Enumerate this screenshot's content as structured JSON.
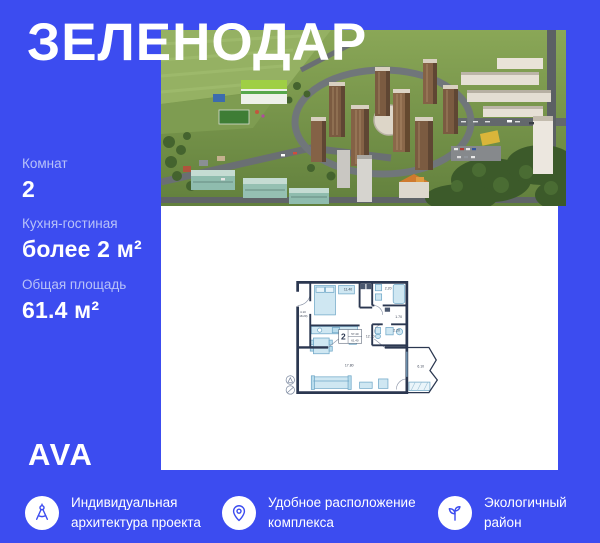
{
  "colors": {
    "background": "#3c4cf0",
    "muted_label_text": "#b8c2f8",
    "panel": "#ffffff",
    "plan_walls": "#2b3750",
    "plan_furniture_fill": "#cfe7f2",
    "icon_accent": "#3c4cf0"
  },
  "header": {
    "title": "ЗЕЛЕНОДАР"
  },
  "specs": [
    {
      "label": "Комнат",
      "value": "2"
    },
    {
      "label": "Кухня-гостиная",
      "value": "более 2 м²"
    },
    {
      "label": "Общая площадь",
      "value": "61.4 м²"
    }
  ],
  "logo": {
    "text": "AVA"
  },
  "features": [
    {
      "icon": "drafting-compass-icon",
      "text": "Индивидуальная архитектура проекта"
    },
    {
      "icon": "location-pin-icon",
      "text": "Удобное расположение комплекса"
    },
    {
      "icon": "leaf-icon",
      "text": "Экологичный район"
    }
  ],
  "floor_plan": {
    "stamp": {
      "rooms": "2",
      "area_living": "57.40",
      "area_total": "61.40"
    },
    "labels": {
      "bedroom": "11.40",
      "bathroom": "2.20",
      "hall": "1.70",
      "wc": "2.20",
      "kitchen_living": "12.70",
      "living_room": "17.80",
      "balcony": "6.10",
      "corridor": "4.10",
      "corridor_alt": "(18.20)"
    }
  }
}
